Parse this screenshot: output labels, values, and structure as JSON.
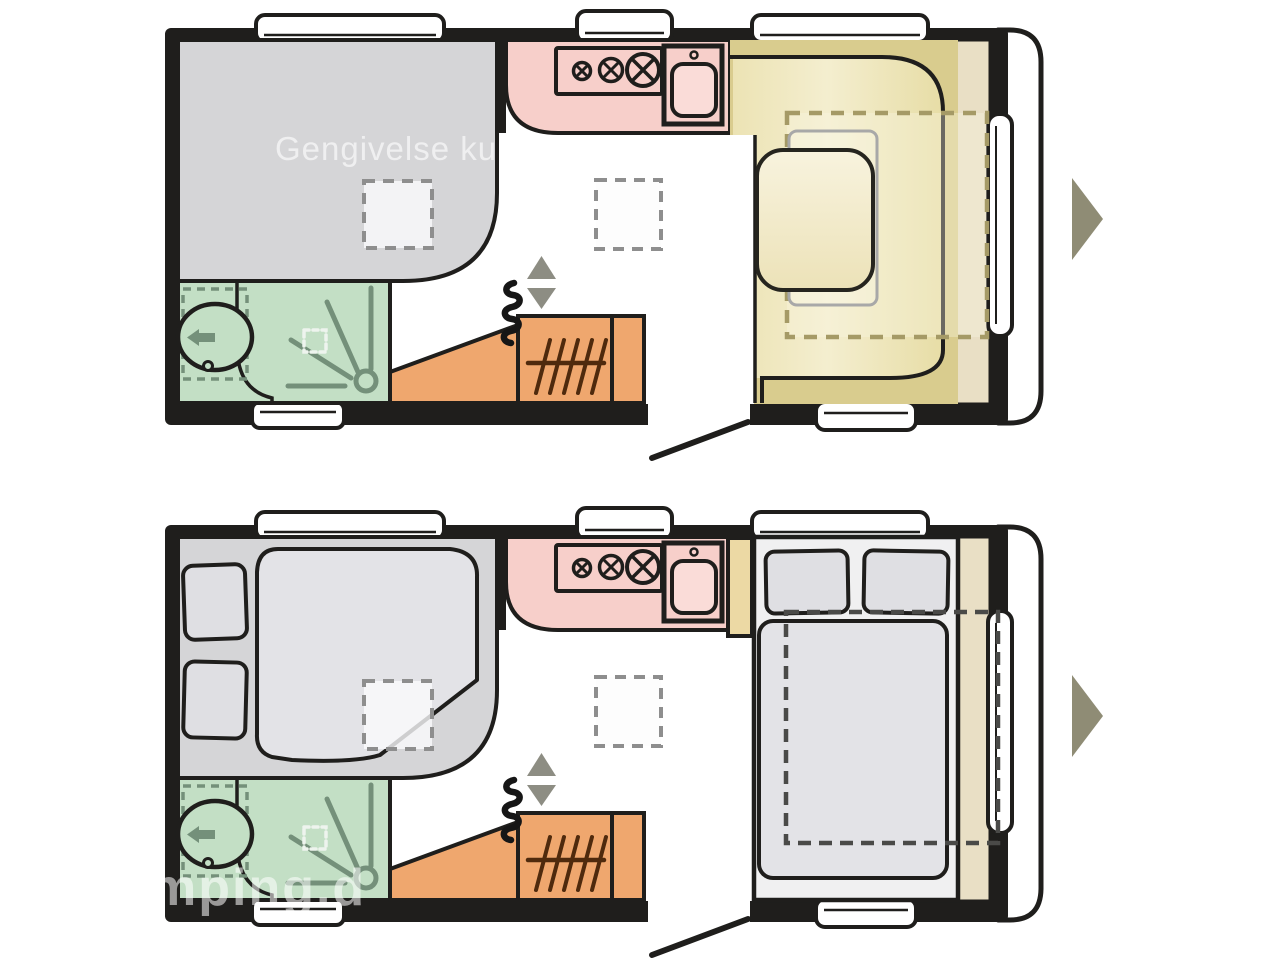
{
  "watermarks": {
    "top": "Gengivelse kun e",
    "bottom": "mping.d"
  },
  "icons": {
    "carousel_next": "right-arrow",
    "vent_up": "triangle-up",
    "vent_down": "triangle-down",
    "toilet_flush_arrow": "arrow-left"
  },
  "plans": [
    {
      "position": "top",
      "description_elements": [
        "lounge-seating",
        "bathroom",
        "kitchen",
        "wardrobe",
        "u-shaped-dinette-with-table"
      ]
    },
    {
      "position": "bottom",
      "description_elements": [
        "made-up-bed-left",
        "bathroom",
        "kitchen",
        "wardrobe",
        "fixed-double-bed-right"
      ]
    }
  ],
  "colors": {
    "background": "#ffffff",
    "wall": "#1f1e1c",
    "lounge_gray": "#d5d5d7",
    "bath_green": "#c3dfc5",
    "bath_line": "#74907a",
    "kitchen_pink": "#f7cfca",
    "kitchen_pink_light": "#fadcd8",
    "furniture_orange": "#efa76e",
    "hanger_brown": "#4f2a0d",
    "bench_khaki": "#d9cc8e",
    "bench_khaki_light": "#f0e8c4",
    "table_cream": "#f5efd6",
    "shelf_tan": "#e9dfc5",
    "cabinet_tan": "#ecd9a4",
    "dash_tan": "#a59a66",
    "dash_gray": "#8e8e8e",
    "dash_dark": "#4a4a48",
    "bedding_gray": "#e3e3e7",
    "pillow_gray": "#dfdfe3",
    "bed_platform": "#f0f0f1",
    "vent_gray": "#8d8d83",
    "arrow_khaki": "#8f8c75",
    "drain_light": "#eef4ee"
  }
}
